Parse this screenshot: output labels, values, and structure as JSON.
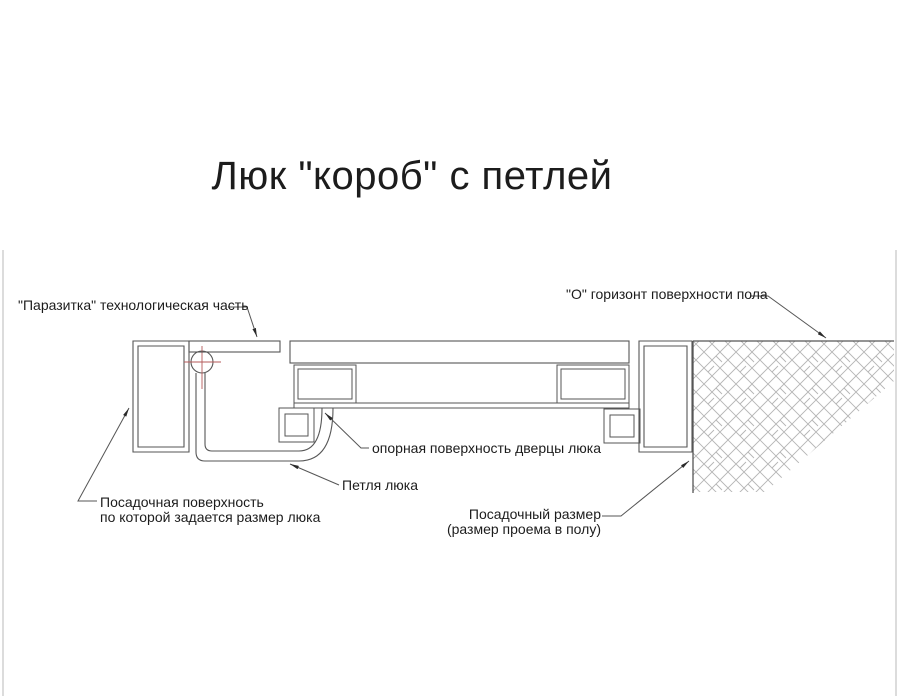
{
  "title": "Люк \"короб\" с петлей",
  "labels": {
    "parasitka": "\"Паразитка\" технологическая часть",
    "floor_horizon": "\"О\" горизонт поверхности пола",
    "door_support": "опорная поверхность дверцы люка",
    "hinge": "Петля люка",
    "seating_surface": {
      "line1": "Посадочная поверхность",
      "line2": "по которой задается размер люка"
    },
    "seating_size": {
      "line1": "Посадочный размер",
      "line2": "(размер проема в полу)"
    }
  },
  "colors": {
    "line": "#565656",
    "hatch": "#9b9b9b",
    "hatch-light": "#b5b5b5",
    "centerline-red": "#b45a5a",
    "gasket": "#d9d9d9",
    "text": "#1c1c1c",
    "frame-edge": "#d0d0d0",
    "background": "#ffffff"
  }
}
